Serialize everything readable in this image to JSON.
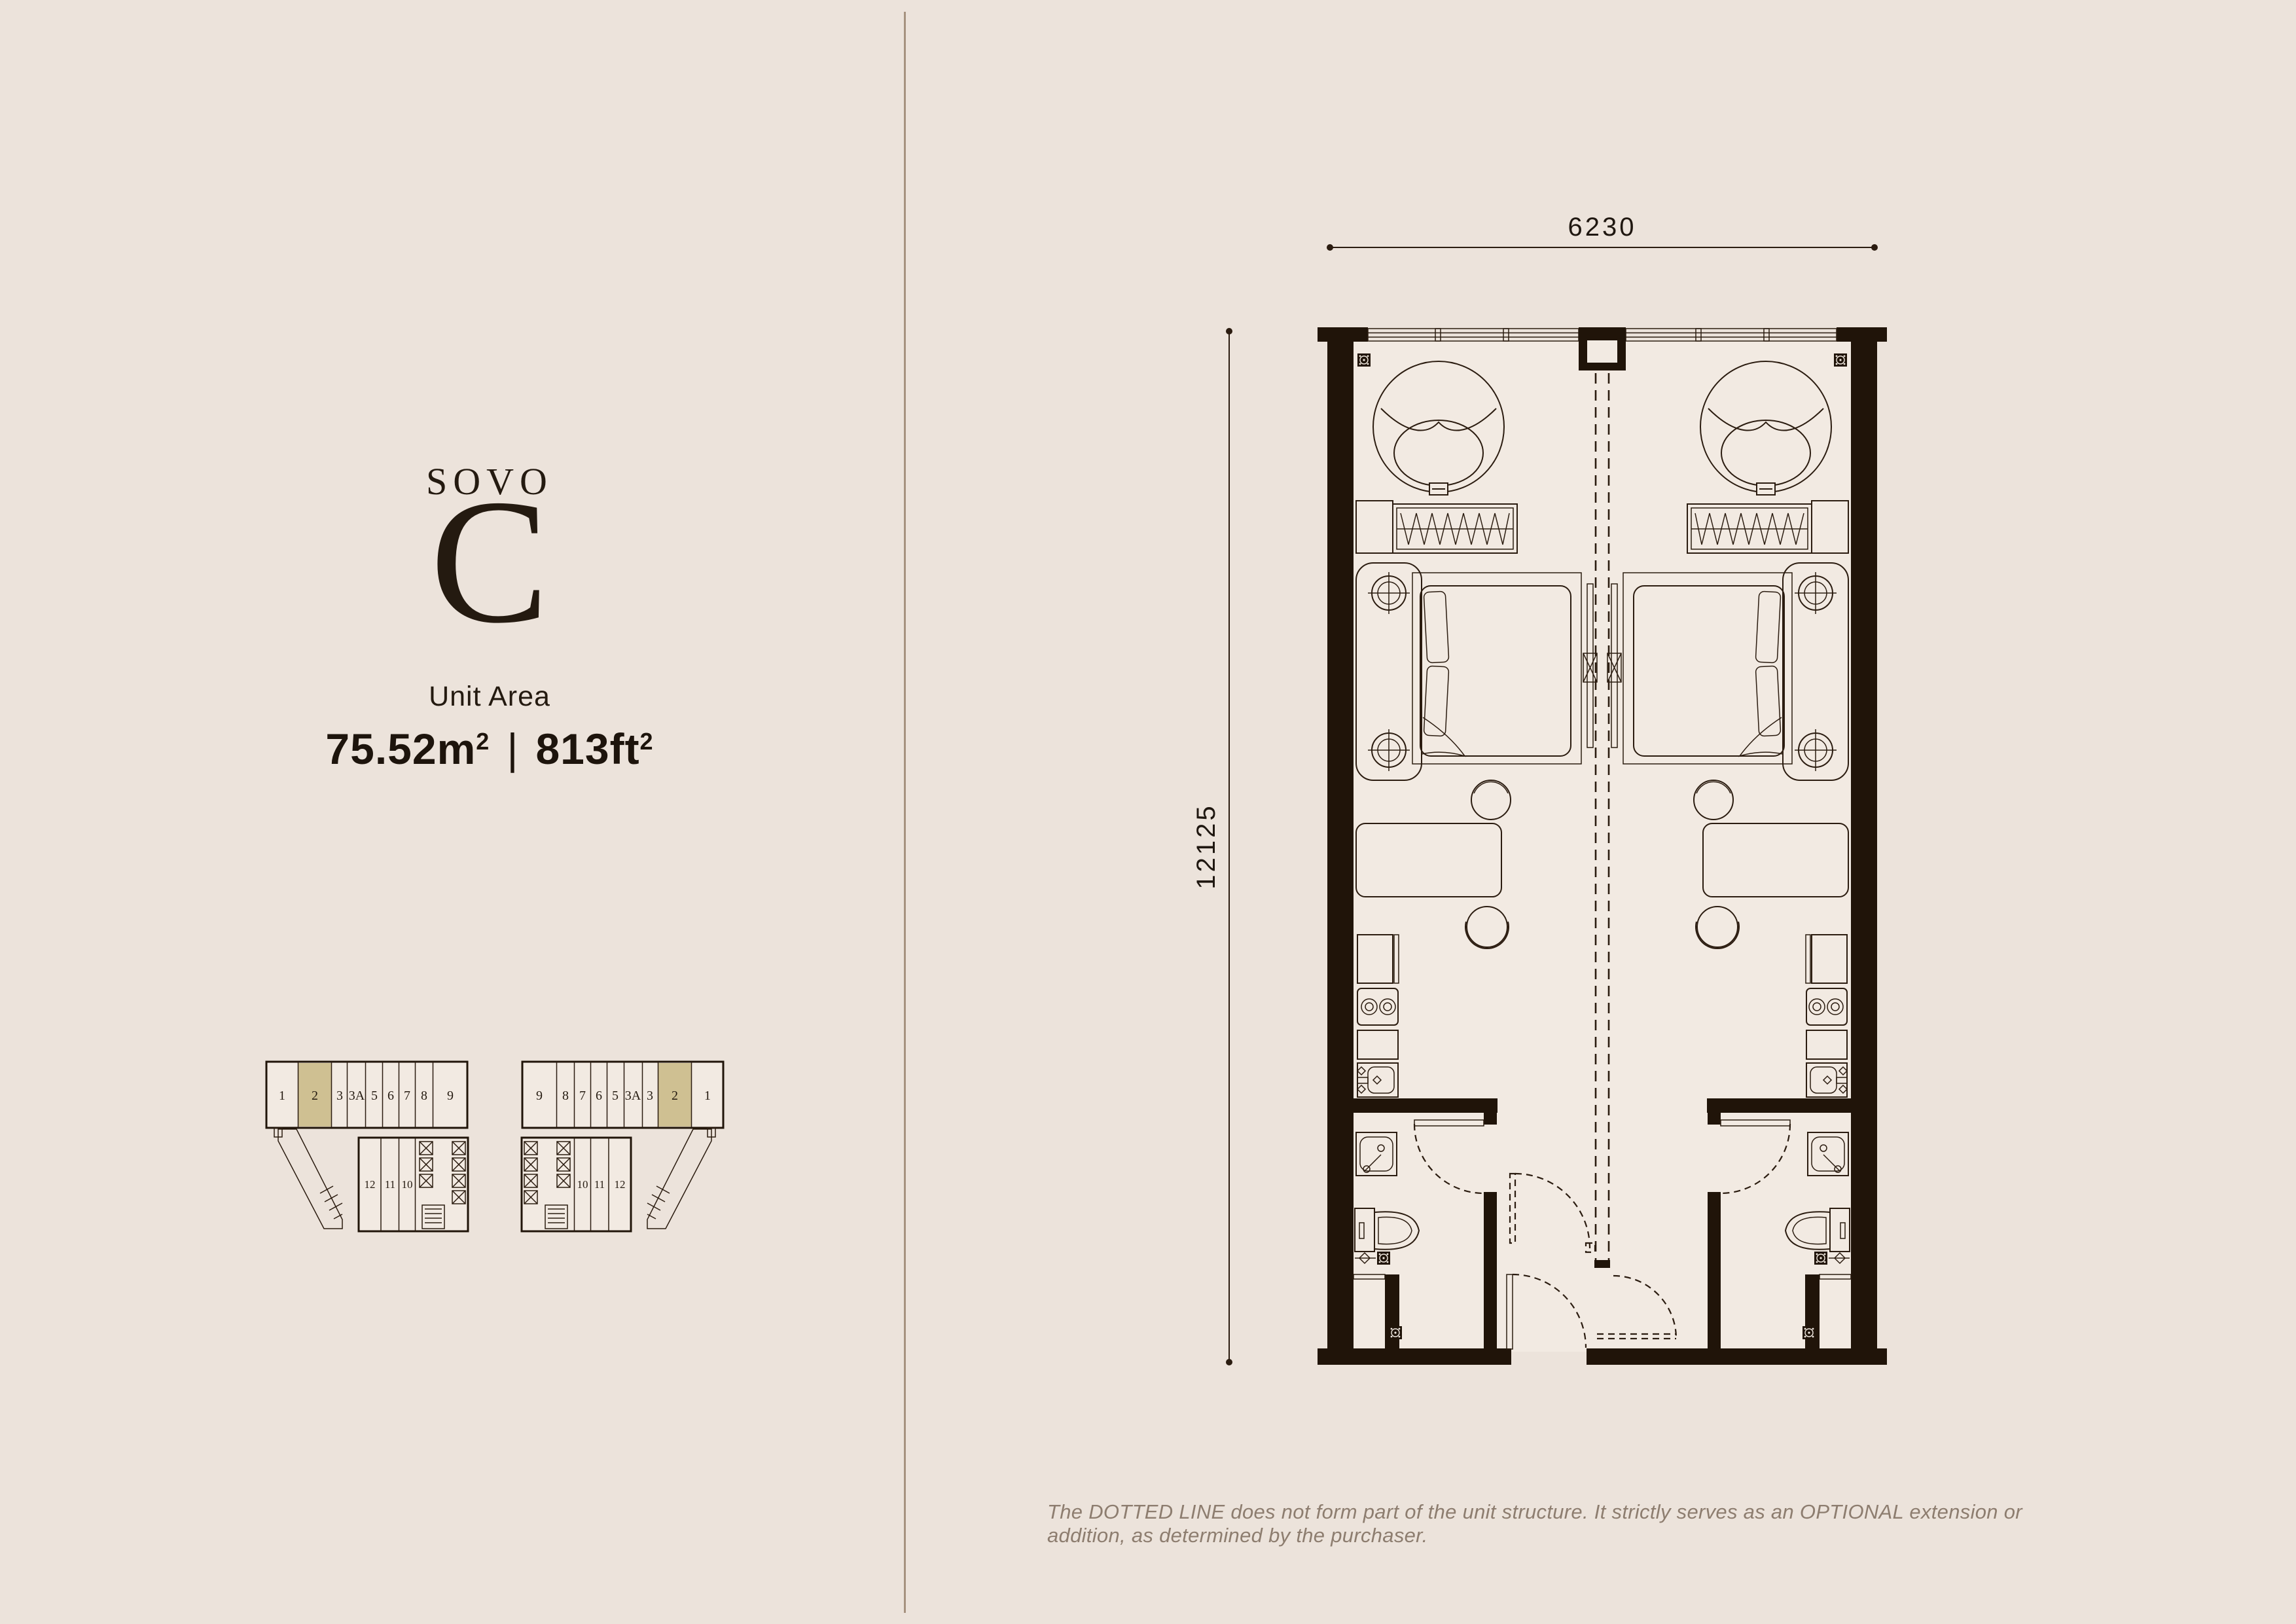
{
  "page": {
    "background": "#ece3db",
    "divider_color": "#a6927f"
  },
  "left_panel": {
    "series_label": "SOVO",
    "type_letter": "C",
    "unit_area_label": "Unit Area",
    "area": {
      "metric": "75.52m",
      "metric_sup": "2",
      "separator": "|",
      "imperial": "813ft",
      "imperial_sup": "2"
    }
  },
  "floor_plan": {
    "width_label": "6230",
    "height_label": "12125",
    "wall_color": "#201409",
    "highlight_color": "#cfc092"
  },
  "keyplans": {
    "left": {
      "top_units": [
        "1",
        "2",
        "3",
        "3A",
        "5",
        "6",
        "7",
        "8",
        "9"
      ],
      "lower_units": [
        "12",
        "11",
        "10"
      ],
      "highlighted_unit": "2"
    },
    "right": {
      "top_units": [
        "9",
        "8",
        "7",
        "6",
        "5",
        "3A",
        "3",
        "2",
        "1"
      ],
      "lower_units": [
        "10",
        "11",
        "12"
      ],
      "highlighted_unit": "2"
    }
  },
  "disclaimer": "The DOTTED LINE does not form part of the unit structure. It strictly serves as an OPTIONAL extension or addition, as determined by the purchaser."
}
